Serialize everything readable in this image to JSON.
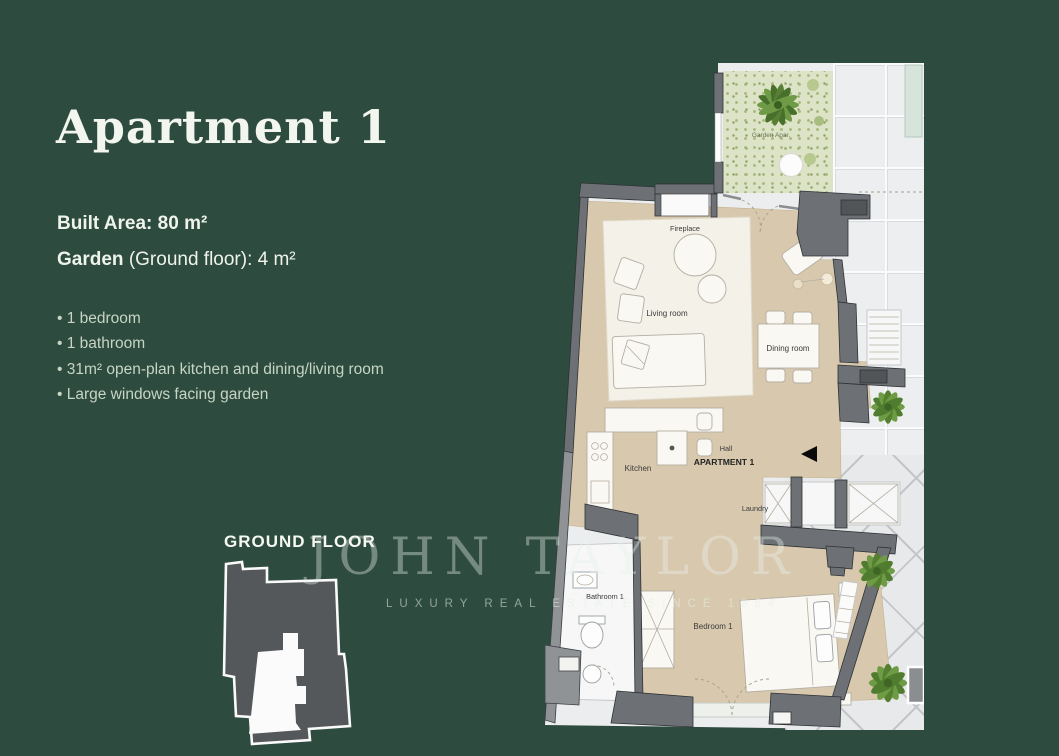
{
  "panel": {
    "title": "Apartment 1",
    "built_area_label": "Built Area:",
    "built_area_value": "80 m²",
    "garden_label": "Garden",
    "garden_value": "(Ground floor): 4 m²",
    "features": [
      "1 bedroom",
      "1 bathroom",
      "31m² open-plan kitchen and dining/living room",
      "Large windows facing garden"
    ],
    "floor_label": "GROUND FLOOR"
  },
  "watermark": {
    "brand": "JOHN TAYLOR",
    "tagline": "LUXURY REAL ESTATE SINCE 1864"
  },
  "floorplan": {
    "labels": {
      "garden": "Garden Apar.",
      "fireplace": "Fireplace",
      "living": "Living room",
      "dining": "Dining room",
      "kitchen": "Kitchen",
      "hall": "Hall",
      "apartment": "APARTMENT 1",
      "laundry": "Laundry",
      "bathroom": "Bathroom 1",
      "bedroom": "Bedroom 1"
    }
  },
  "colors": {
    "background": "#2e4b3f",
    "heading_text": "#f2f6ef",
    "feature_text": "#c6d5c4",
    "floor_beige": "#d8c9ae",
    "wall_gray": "#6d7175",
    "garden_green": "#dde3c6",
    "terrace_gray": "#ecedee",
    "plant_green": "#5f8f3a"
  }
}
